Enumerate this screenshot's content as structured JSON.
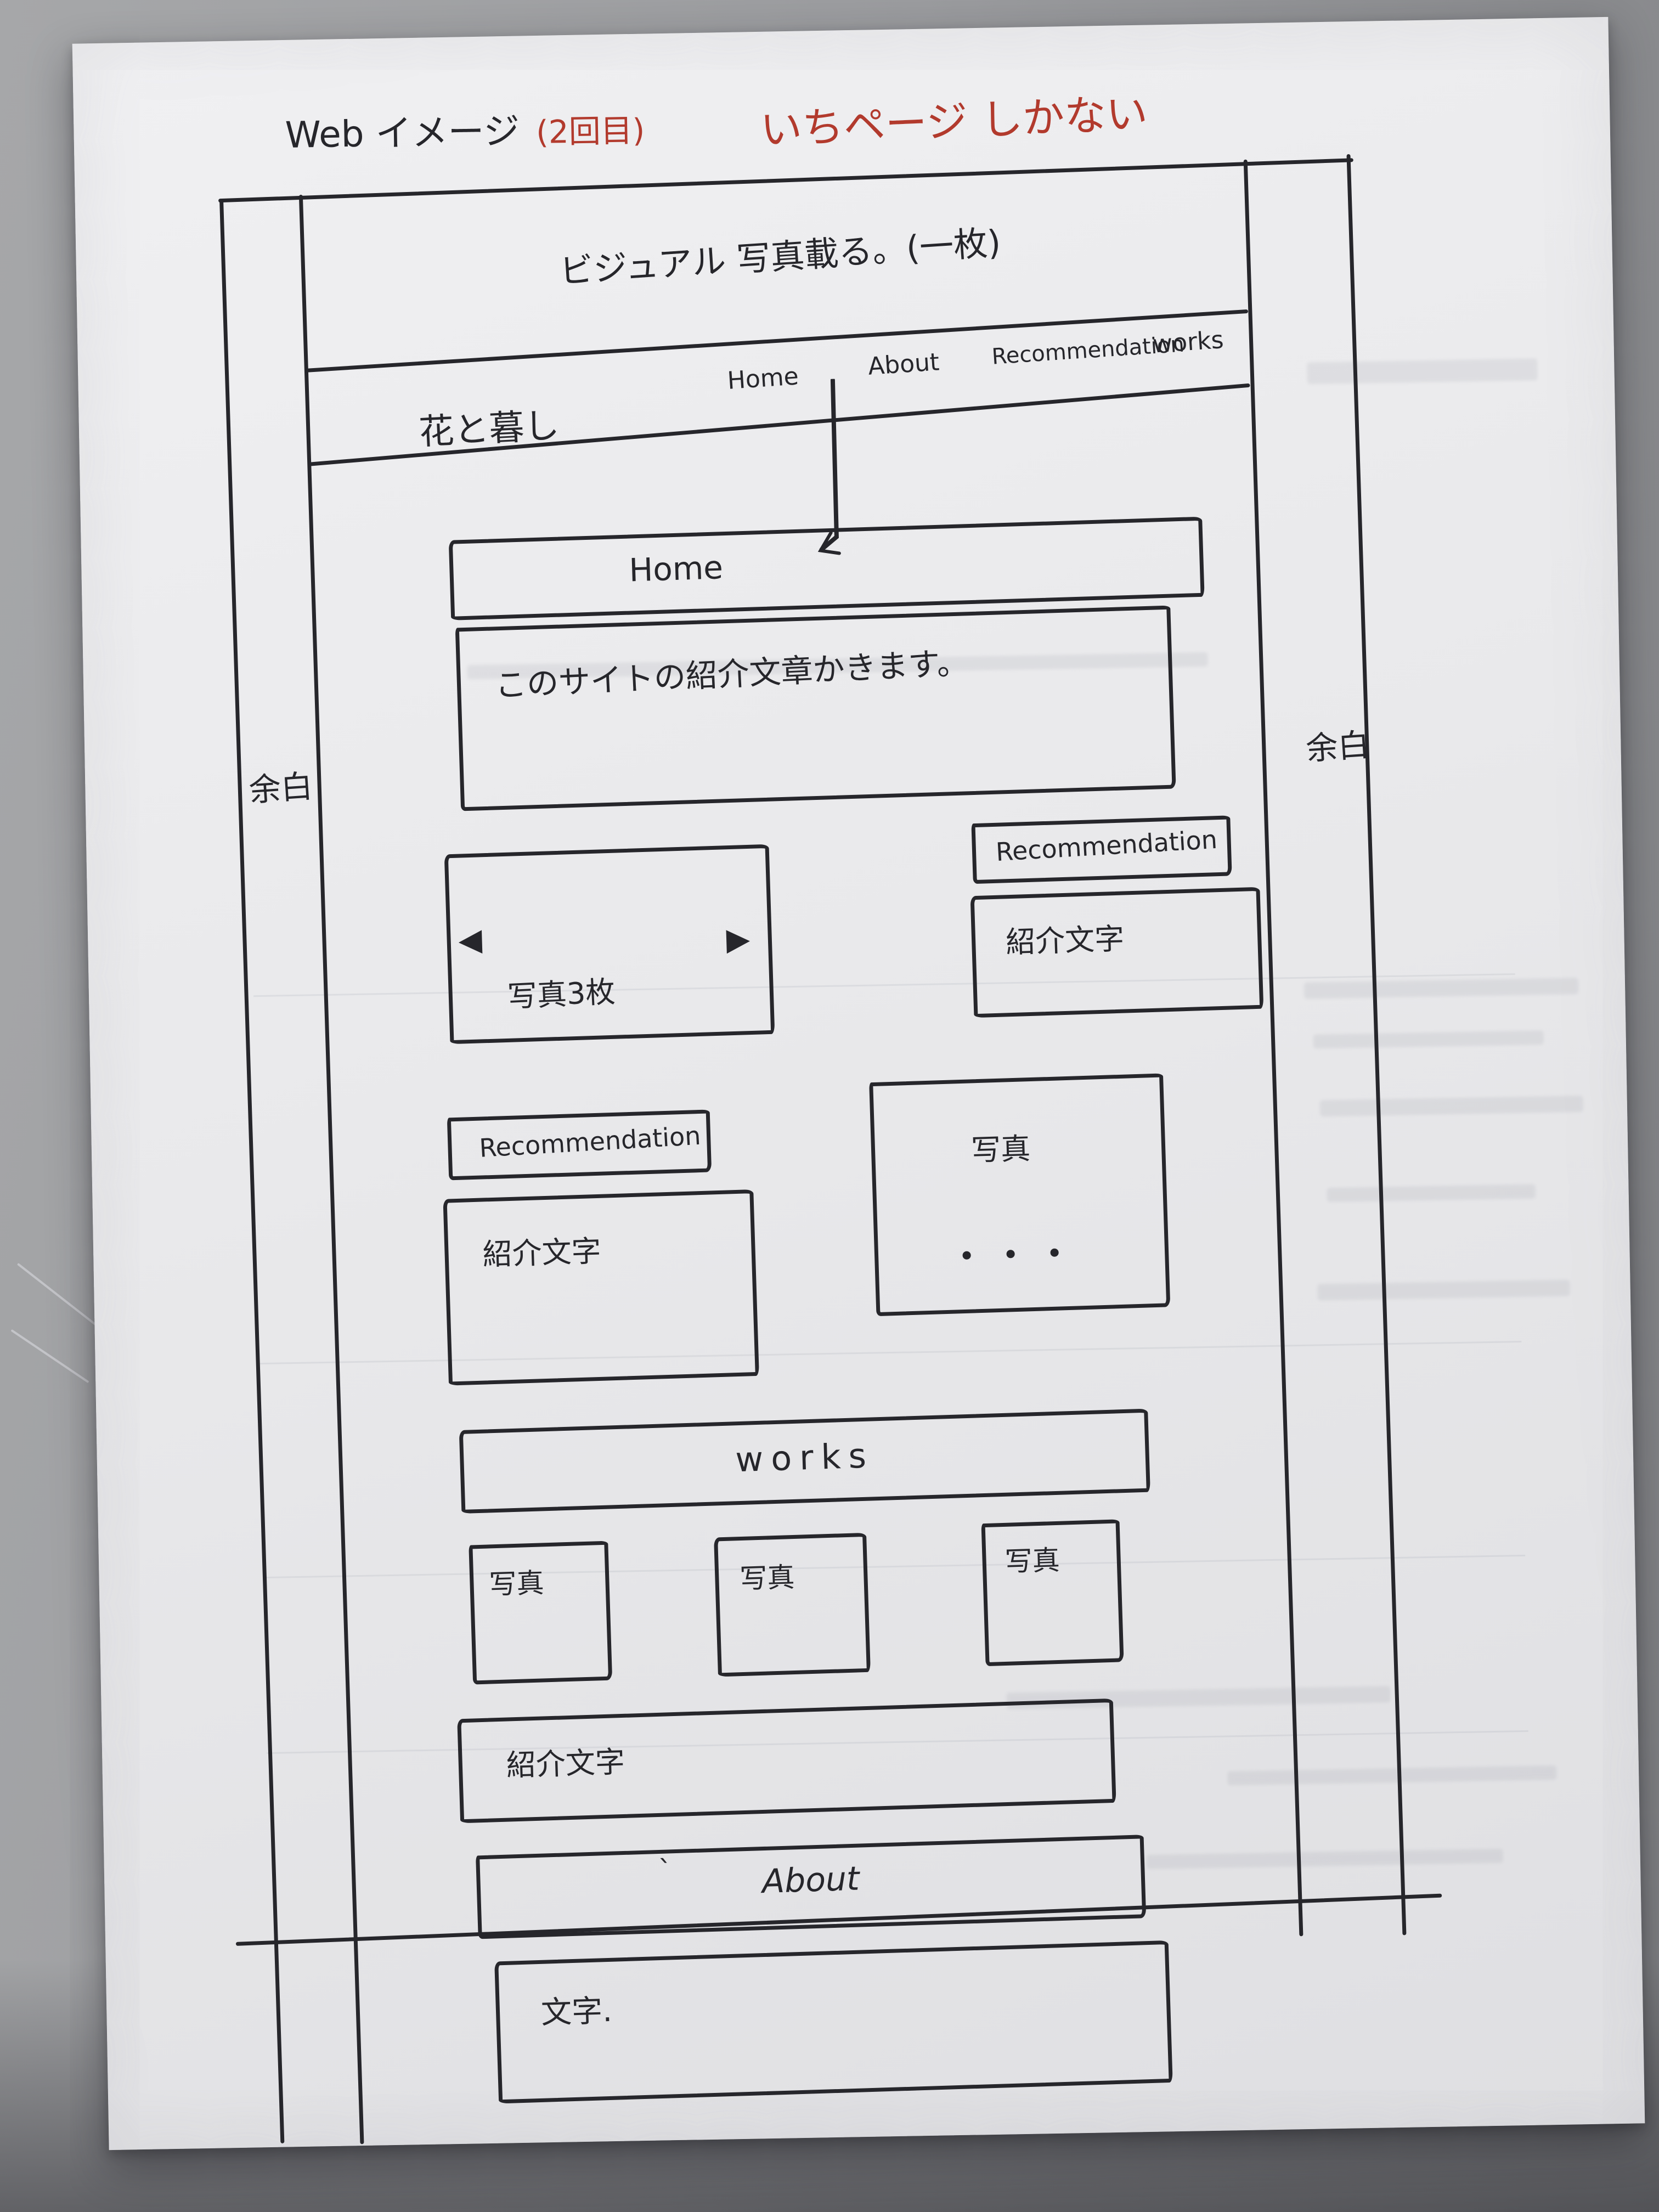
{
  "annotations": {
    "title": "Web イメージ",
    "revision_note": "(2回目)",
    "page_note": "いちページ しかない"
  },
  "colors": {
    "ink": "#26262b",
    "red_pen": "#b23a2d"
  },
  "wireframe": {
    "hero_note": "ビジュアル 写真載る。(一枚)",
    "left_margin_label": "余白",
    "right_margin_label": "余白",
    "nav": {
      "logo": "花と暮し",
      "items": [
        {
          "label": "Home"
        },
        {
          "label": "About"
        },
        {
          "label": "Recommendation"
        },
        {
          "label": "works"
        }
      ]
    },
    "home_section": {
      "heading": "Home",
      "intro_note": "このサイトの紹介文章かきます。"
    },
    "carousel": {
      "prev_icon": "◀",
      "next_icon": "▶",
      "label": "写真3枚"
    },
    "recommendation_right": {
      "heading": "Recommendation",
      "body_note": "紹介文字"
    },
    "recommendation_left": {
      "heading": "Recommendation",
      "body_note": "紹介文字"
    },
    "photos_more": {
      "photo_label": "写真",
      "more_dots": "・・・"
    },
    "works_section": {
      "heading": "works",
      "photo_labels": [
        "写真",
        "写真",
        "写真"
      ],
      "body_note": "紹介文字"
    },
    "about_section": {
      "heading": "About",
      "stray_mark": "`",
      "body_note": "文字."
    }
  }
}
